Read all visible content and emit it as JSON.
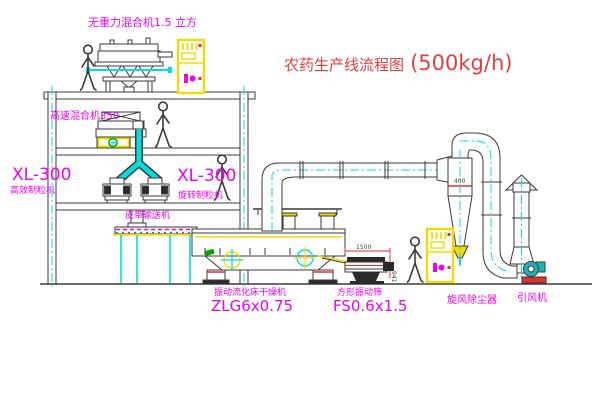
{
  "title": {
    "name_cn": "农药生产线流程图",
    "capacity": "(500kg/h)"
  },
  "equipment_labels": {
    "gravity_mixer": "无重力混合机1.5 立方",
    "high_speed_mixer": "高速混合机350",
    "left_unit_model": "XL-300",
    "left_unit_name": "高效制粒机",
    "granulator_model": "XL-300",
    "granulator_name": "旋转制粒机",
    "belt_conveyor": "皮带输送机",
    "dryer_name": "振动流化床干燥机",
    "dryer_model": "ZLG6x0.75",
    "sieve_name": "方形振动筛",
    "sieve_model": "FS0.6x1.5",
    "cyclone_name": "旋风除尘器",
    "fan_name": "引风机"
  },
  "dimensions": {
    "sieve_length": "1500",
    "sieve_height": "941",
    "cyclone_diameter": "400"
  },
  "colors": {
    "line": "#3a3a3a",
    "structure_yellow": "#f0dc00",
    "centerline_cyan": "#00dede",
    "label_magenta": "#f000f0",
    "title_red": "#e04040",
    "accent_red": "#e23030",
    "accent_green": "#00a800",
    "fan_teal": "#19b5b5",
    "background": "#ffffff"
  }
}
